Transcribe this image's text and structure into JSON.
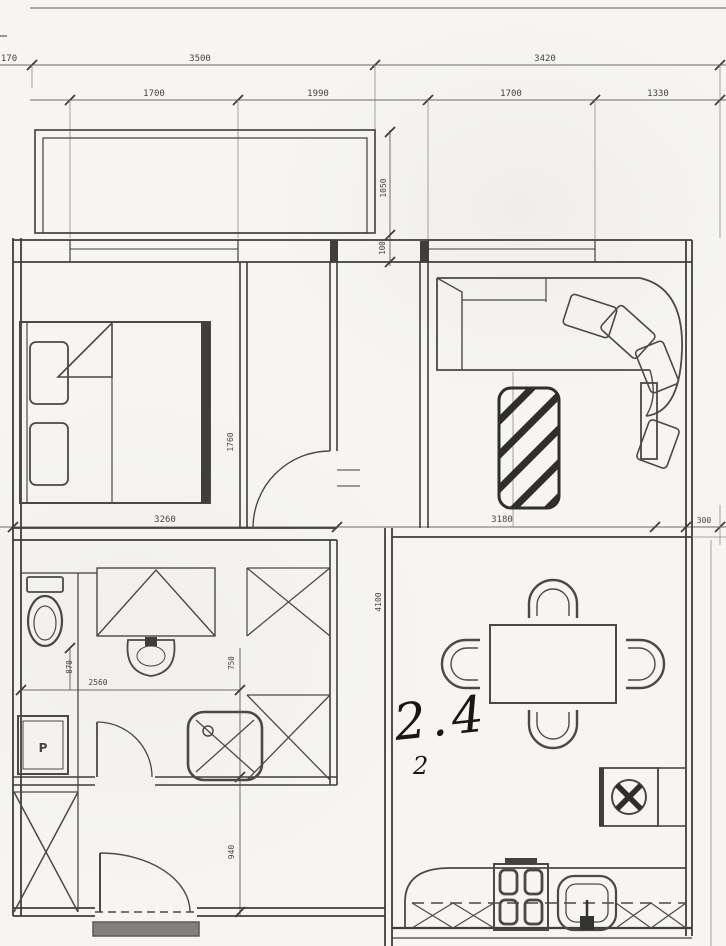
{
  "plan": {
    "title": "apartment floor plan (scanned blueprint)",
    "colors": {
      "ink": "#46443f",
      "paper": "#f6f5f2"
    },
    "annotations": {
      "room_note": "2.4",
      "floor_note": "2",
      "washer_label": "P"
    },
    "dims": {
      "offset_left": "170",
      "top_left": "3500",
      "top_right": "3420",
      "window_bedroom": "1700",
      "hall_span": "1990",
      "window_living": "1700",
      "right_span": "1330",
      "balcony_depth": "1050",
      "balcony_sill": "100",
      "bedroom_depth": "1760",
      "mid_left": "3260",
      "mid_right": "3180",
      "right_edge": "300",
      "bath_width": "2560",
      "bath_left_depth": "870",
      "bath_right_depth": "750",
      "hall_depth": "940",
      "dining_depth": "4100"
    }
  }
}
